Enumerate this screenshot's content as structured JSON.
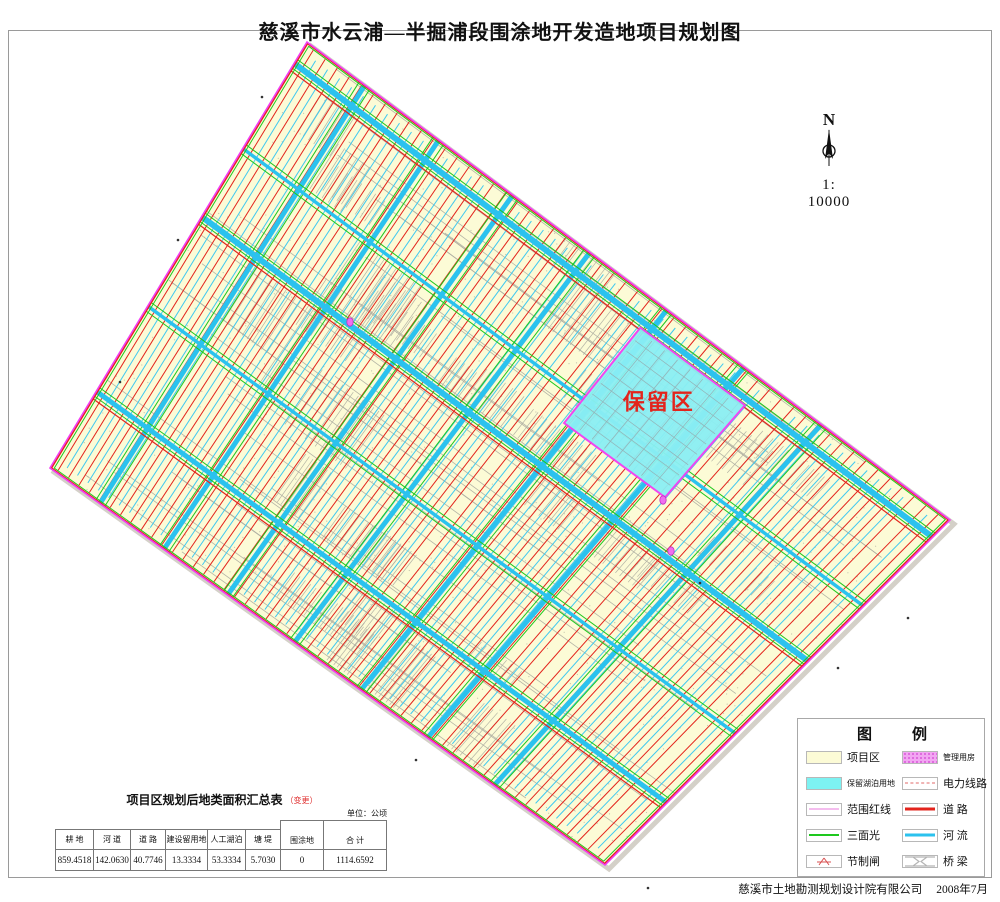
{
  "title": "慈溪市水云浦—半掘浦段围涂地开发造地项目规划图",
  "compass": {
    "north_label": "N",
    "scale_label": "1: 10000"
  },
  "map": {
    "reserved_area_label": "保留区",
    "palette": {
      "land_fill": "#FCFBD6",
      "road_red": "#E3241C",
      "river_cyan": "#2BC2EE",
      "minor_cyan": "#3FC8F0",
      "green_line": "#1EC81E",
      "boundary_magenta": "#F23DF2",
      "reserved_fill": "#8BEFF4",
      "terrain_gray": "#ADADA0",
      "house_magenta": "#F06EF0",
      "label_red": "#E3241C"
    }
  },
  "legend": {
    "title": [
      "图",
      "例"
    ],
    "left_items": [
      {
        "label": "项目区"
      },
      {
        "label": "保留湖泊用地"
      },
      {
        "label": "范围红线"
      },
      {
        "label": "三面光"
      },
      {
        "label": "节制闸"
      }
    ],
    "right_items": [
      {
        "label": "管理用房"
      },
      {
        "label": "电力线路"
      },
      {
        "label": "道 路"
      },
      {
        "label": "河 流"
      },
      {
        "label": "桥 梁"
      }
    ]
  },
  "area_table": {
    "title": "项目区规划后地类面积汇总表",
    "title_note": "（变更）",
    "unit_note": "单位：公顷",
    "columns": [
      "耕 地",
      "河 道",
      "道 路",
      "建设留用地",
      "人工湖泊",
      "塘 堤",
      "围涂地",
      "合 计"
    ],
    "values": [
      "859.4518",
      "142.0630",
      "40.7746",
      "13.3334",
      "53.3334",
      "5.7030",
      "0",
      "1114.6592"
    ]
  },
  "footer": {
    "company": "慈溪市土地勘测规划设计院有限公司",
    "date": "2008年7月"
  }
}
